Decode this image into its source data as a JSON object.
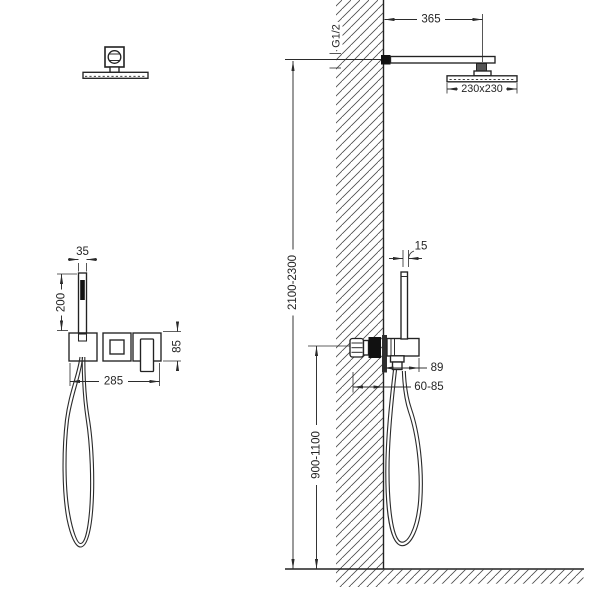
{
  "drawing": {
    "type": "technical-installation-diagram",
    "subject": "concealed shower system with rain head and hand shower",
    "background_color": "#ffffff",
    "line_color": "#2b2b2b",
    "fill_dark": "#111111"
  },
  "dims": {
    "head_arm_offset": "365",
    "thread_size": "G1/2",
    "head_size": "230x230",
    "handshower_width": "35",
    "handshower_length": "200",
    "trim_plate_height": "85",
    "trim_plate_width": "285",
    "handshower_depth": "15",
    "valve_projection": "89",
    "rough_in_depth": "60-85",
    "overall_height": "2100-2300",
    "valve_height": "900-1100"
  }
}
